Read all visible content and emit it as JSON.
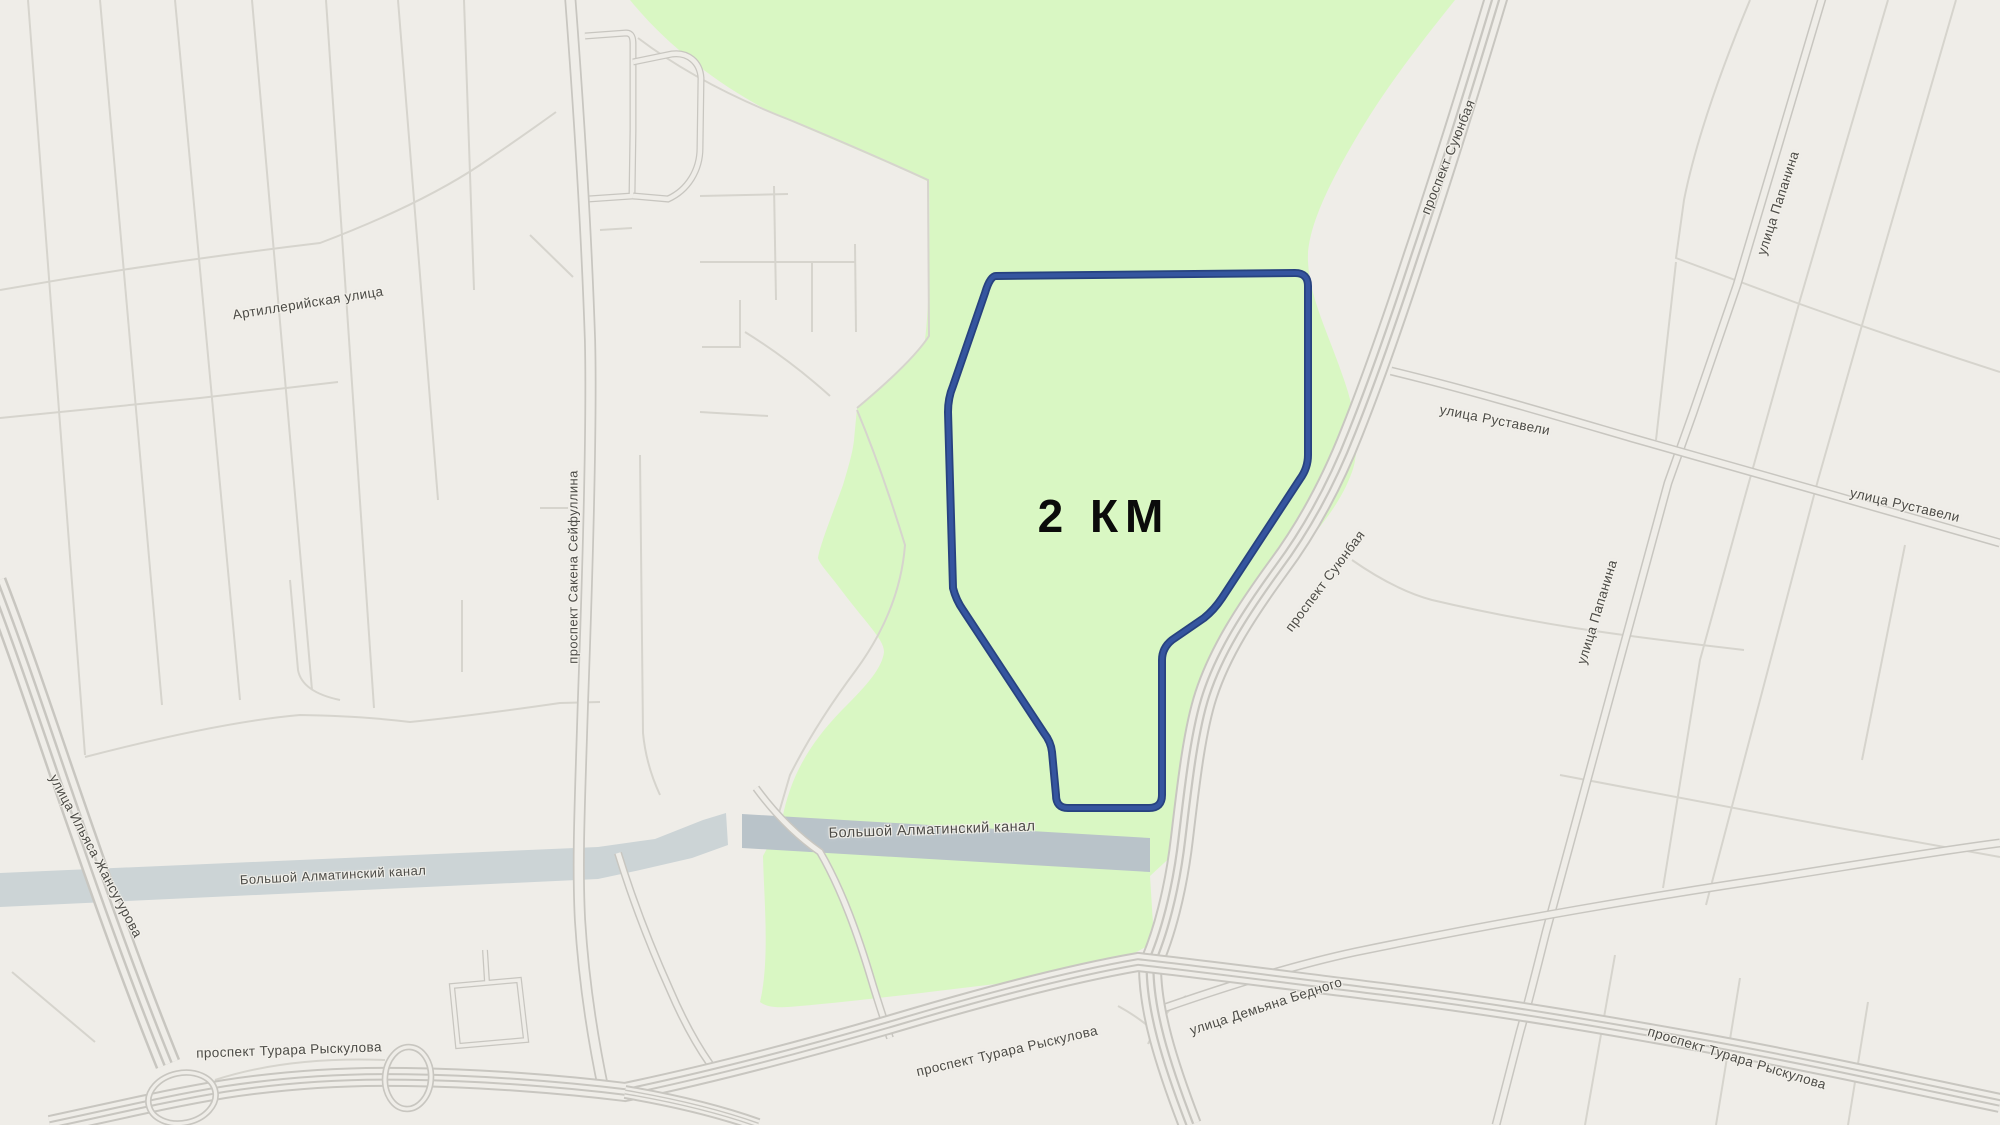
{
  "map": {
    "distance_label": "2 КМ",
    "streets": {
      "artilleriyskaya": "Артиллерийская улица",
      "seyfullin": "проспект Сакена Сейфуллина",
      "suyunbay": "проспект Суюнбая",
      "papanin": "улица Папанина",
      "rustaveli": "улица Руставели",
      "zhansugurov": "улица Ильяса Жансугурова",
      "canal": "Большой Алматинский канал",
      "ryskulov": "проспект Турара Рыскулова",
      "demyan": "улица Демьяна Бедного"
    },
    "colors": {
      "bg": "#efede8",
      "park": "#d9f7c3",
      "canal": "#b9c3c9",
      "canal-light": "#ccd4d6",
      "road": "#c8c6c0",
      "road-thin": "#d6d4cd",
      "route": "#35559f",
      "route-dark": "#27427f",
      "label": "#4c4b47"
    }
  }
}
